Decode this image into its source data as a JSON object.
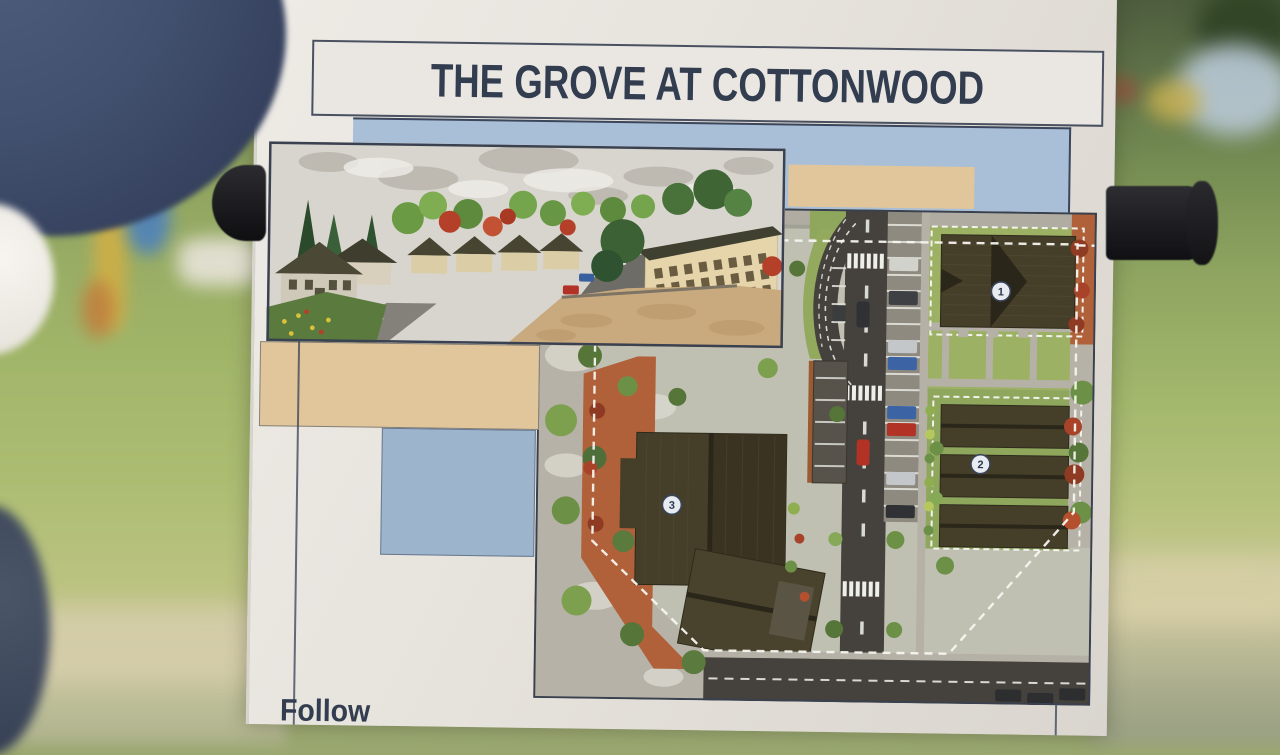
{
  "poster": {
    "title": "THE GROVE AT COTTONWOOD",
    "bottom_partial_text": "Follow",
    "site_plan_markers": [
      {
        "label": "1"
      },
      {
        "label": "2"
      },
      {
        "label": "3"
      }
    ],
    "colors": {
      "title_text": "#333d50",
      "paper": "#e7e3dd",
      "band_blue": "#a9bfd7",
      "block_tan": "#e1c69c",
      "block_blue": "#9cb4cc",
      "frame_line": "#424a5c",
      "site_plan_road": "#45413c",
      "site_plan_plaza_orange": "#b0613a",
      "roof_dark": "#453e29"
    }
  }
}
